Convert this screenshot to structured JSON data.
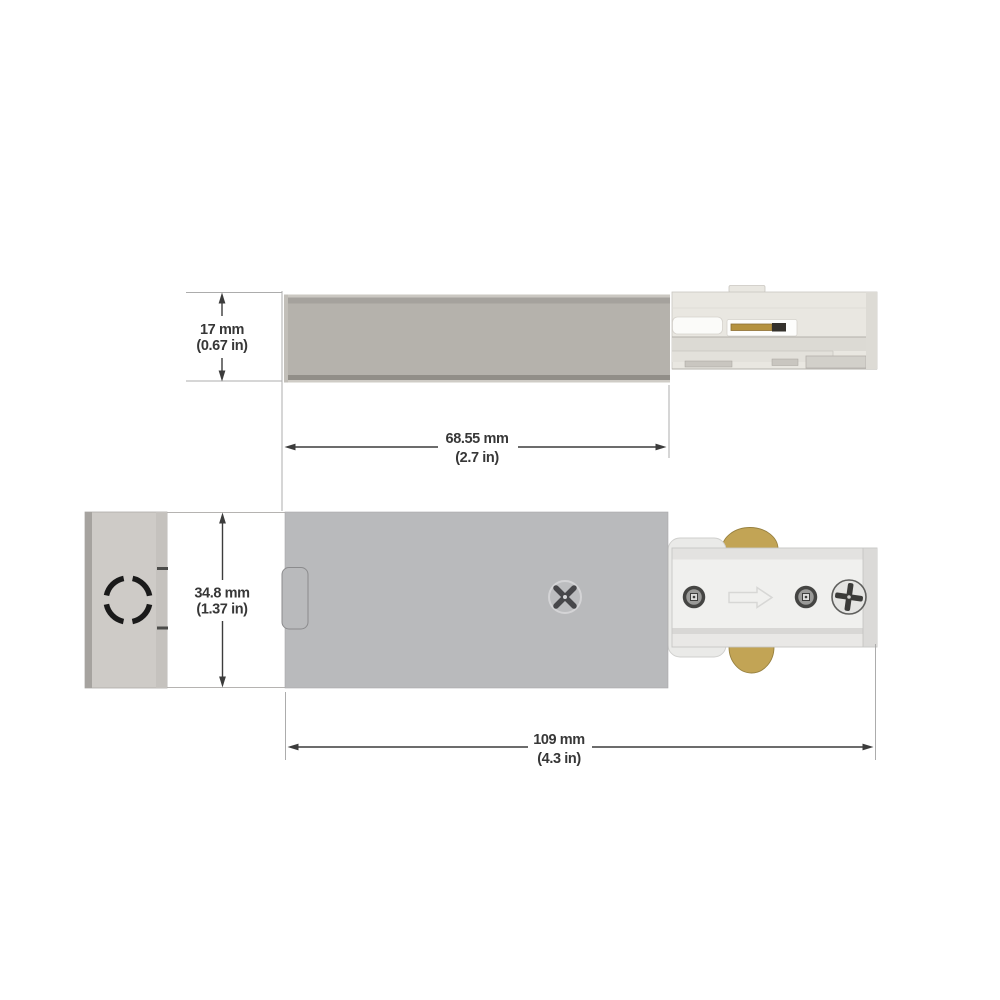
{
  "drawing": {
    "dimensions": {
      "height": {
        "mm": "17 mm",
        "inches": "(0.67 in)"
      },
      "body_length": {
        "mm": "68.55 mm",
        "inches": "(2.7 in)"
      },
      "body_width": {
        "mm": "34.8 mm",
        "inches": "(1.37 in)"
      },
      "overall_length": {
        "mm": "109 mm",
        "inches": "(4.3 in)"
      }
    },
    "colors": {
      "background": "#ffffff",
      "side_body_grey": "#b5b2ac",
      "bottom_body_grey": "#b9babc",
      "junction_box_grey": "#cecbc7",
      "track_cream": "#e9e7e1",
      "track_white": "#f0f0ee",
      "brass_tab": "#c2a455",
      "brass_contact": "#b5923f",
      "dimension_line": "#3c3c3c",
      "extension_line": "#acacac",
      "knockout_black": "#1a1a1a",
      "text": "#373737"
    }
  }
}
